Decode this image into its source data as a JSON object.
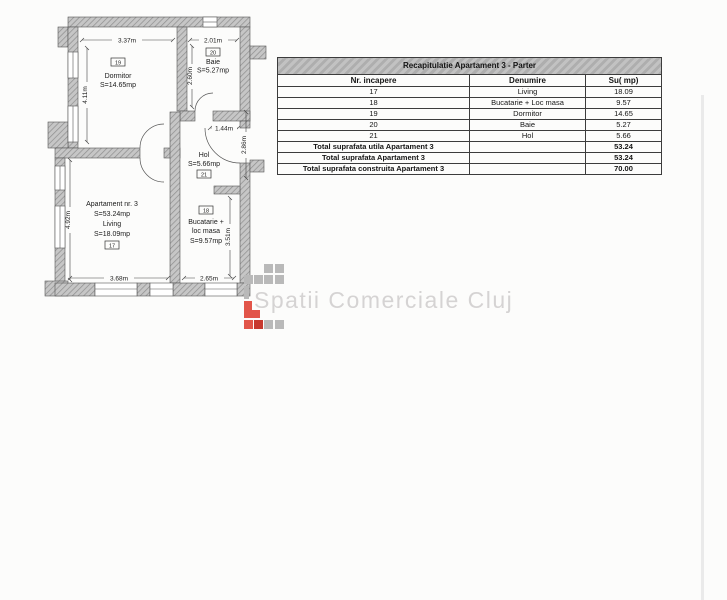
{
  "watermark": {
    "text": "Spatii Comerciale Cluj"
  },
  "floorplan": {
    "apartment": {
      "name": "Apartament nr. 3",
      "area": "S=53.24mp"
    },
    "rooms": {
      "dormitor": {
        "number": "19",
        "name": "Dormitor",
        "area": "S=14.65mp"
      },
      "baie": {
        "number": "20",
        "name": "Baie",
        "area": "S=5.27mp"
      },
      "hol": {
        "number": "21",
        "name": "Hol",
        "area": "S=5.66mp"
      },
      "living": {
        "number": "17",
        "name": "Living",
        "area": "S=18.09mp"
      },
      "bucatarie": {
        "number": "18",
        "name_line1": "Bucatarie +",
        "name_line2": "loc masa",
        "area": "S=9.57mp"
      }
    },
    "dimensions": {
      "dormitor_width": "3.37m",
      "baie_width": "2.01m",
      "dormitor_height": "4.11m",
      "baie_height": "2.60m",
      "hol_width": "1.44m",
      "hol_height": "2.86m",
      "living_height": "4.92m",
      "living_width": "3.68m",
      "bucatarie_width": "2.65m",
      "bucatarie_height": "3.51m"
    }
  },
  "table": {
    "title": "Recapitulatie Apartament 3 - Parter",
    "headers": {
      "nr": "Nr. incapere",
      "denumire": "Denumire",
      "su": "Su( mp)"
    },
    "rows": [
      {
        "nr": "17",
        "denumire": "Living",
        "su": "18.09"
      },
      {
        "nr": "18",
        "denumire": "Bucatarie + Loc masa",
        "su": "9.57"
      },
      {
        "nr": "19",
        "denumire": "Dormitor",
        "su": "14.65"
      },
      {
        "nr": "20",
        "denumire": "Baie",
        "su": "5.27"
      },
      {
        "nr": "21",
        "denumire": "Hol",
        "su": "5.66"
      }
    ],
    "totals": [
      {
        "label": "Total suprafata utila Apartament 3",
        "value": "53.24"
      },
      {
        "label": "Total suprafata Apartament 3",
        "value": "53.24"
      },
      {
        "label": "Total suprafata construita Apartament 3",
        "value": "70.00"
      }
    ]
  },
  "colors": {
    "wall_gray": "#bdbdbd",
    "logo_gray": "#b9b9b9",
    "logo_red": "#e25549",
    "logo_dark_red": "#c7392f",
    "watermark_text": "#d5d3d3"
  }
}
